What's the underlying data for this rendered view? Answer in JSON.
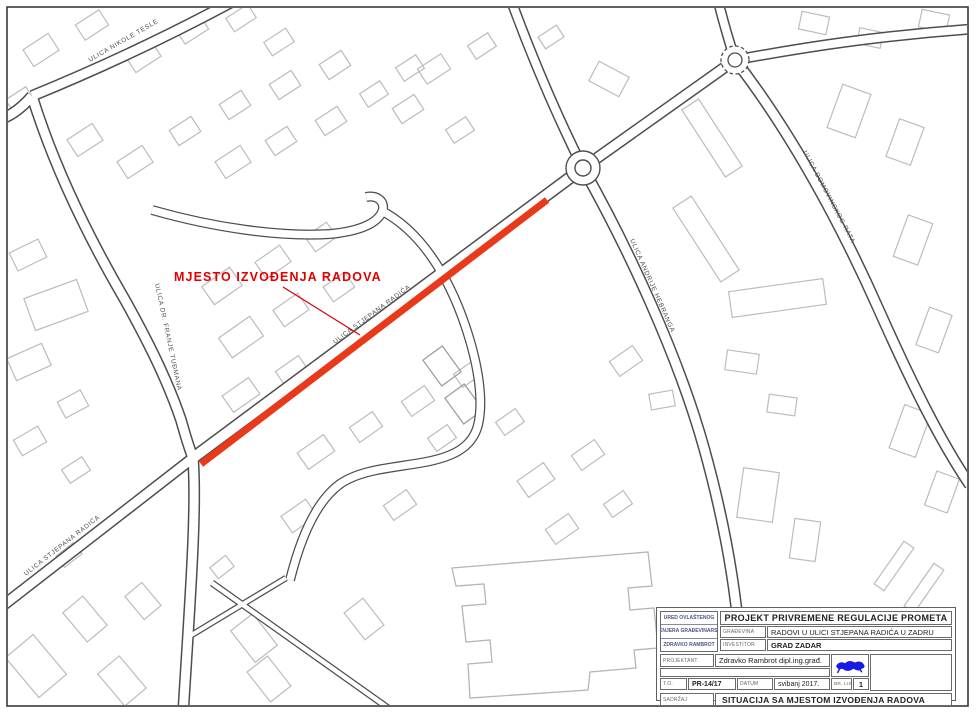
{
  "map": {
    "work_label": "MJESTO IZVOĐENJA RADOVA",
    "streets": {
      "nikole_tesle": "ULICA NIKOLE TESLE",
      "franje_tudmana": "ULICA DR. FRANJE TUĐMANA",
      "stjepana_radica_main": "ULICA STJEPANA RADIĆA",
      "stjepana_radica_sw": "ULICA STJEPANA RADIĆA",
      "andrije_hebranga": "ULICA ANDRIJE HEBRANGA",
      "domovinskog_rata": "ULICA DOMOVINSKOG RATA"
    },
    "colors": {
      "work_highlight": "#e8391a",
      "label_red": "#e10000"
    }
  },
  "title_block": {
    "office": {
      "line1": "URED OVLAŠTENOG",
      "line2": "INŽENJERA GRAĐEVINARSTVA",
      "line3": "ZDRAVKO RAMBROT"
    },
    "project_title": "PROJEKT PRIVREMENE REGULACIJE PROMETA",
    "gradevina_label": "GRAĐEVINA",
    "gradevina_value": "RADOVI U ULICI STJEPANA RADIĆA U ZADRU",
    "investitor_label": "INVESTITOR",
    "investitor_value": "GRAD ZADAR",
    "projektant_label": "PROJEKTANT",
    "projektant_value": "Zdravko Rambrot dipl.ing.građ.",
    "to_label": "T.O.",
    "to_value": "PR-14/17",
    "datum_label": "DATUM",
    "datum_value": "svibanj 2017.",
    "br_lista_label": "BR. LISTA",
    "br_lista_value": "1",
    "sadrzaj_label": "SADRŽAJ",
    "sadrzaj_value": "SITUACIJA SA MJESTOM IZVOĐENJA RADOVA",
    "stamp_color": "#1a1ae6"
  }
}
